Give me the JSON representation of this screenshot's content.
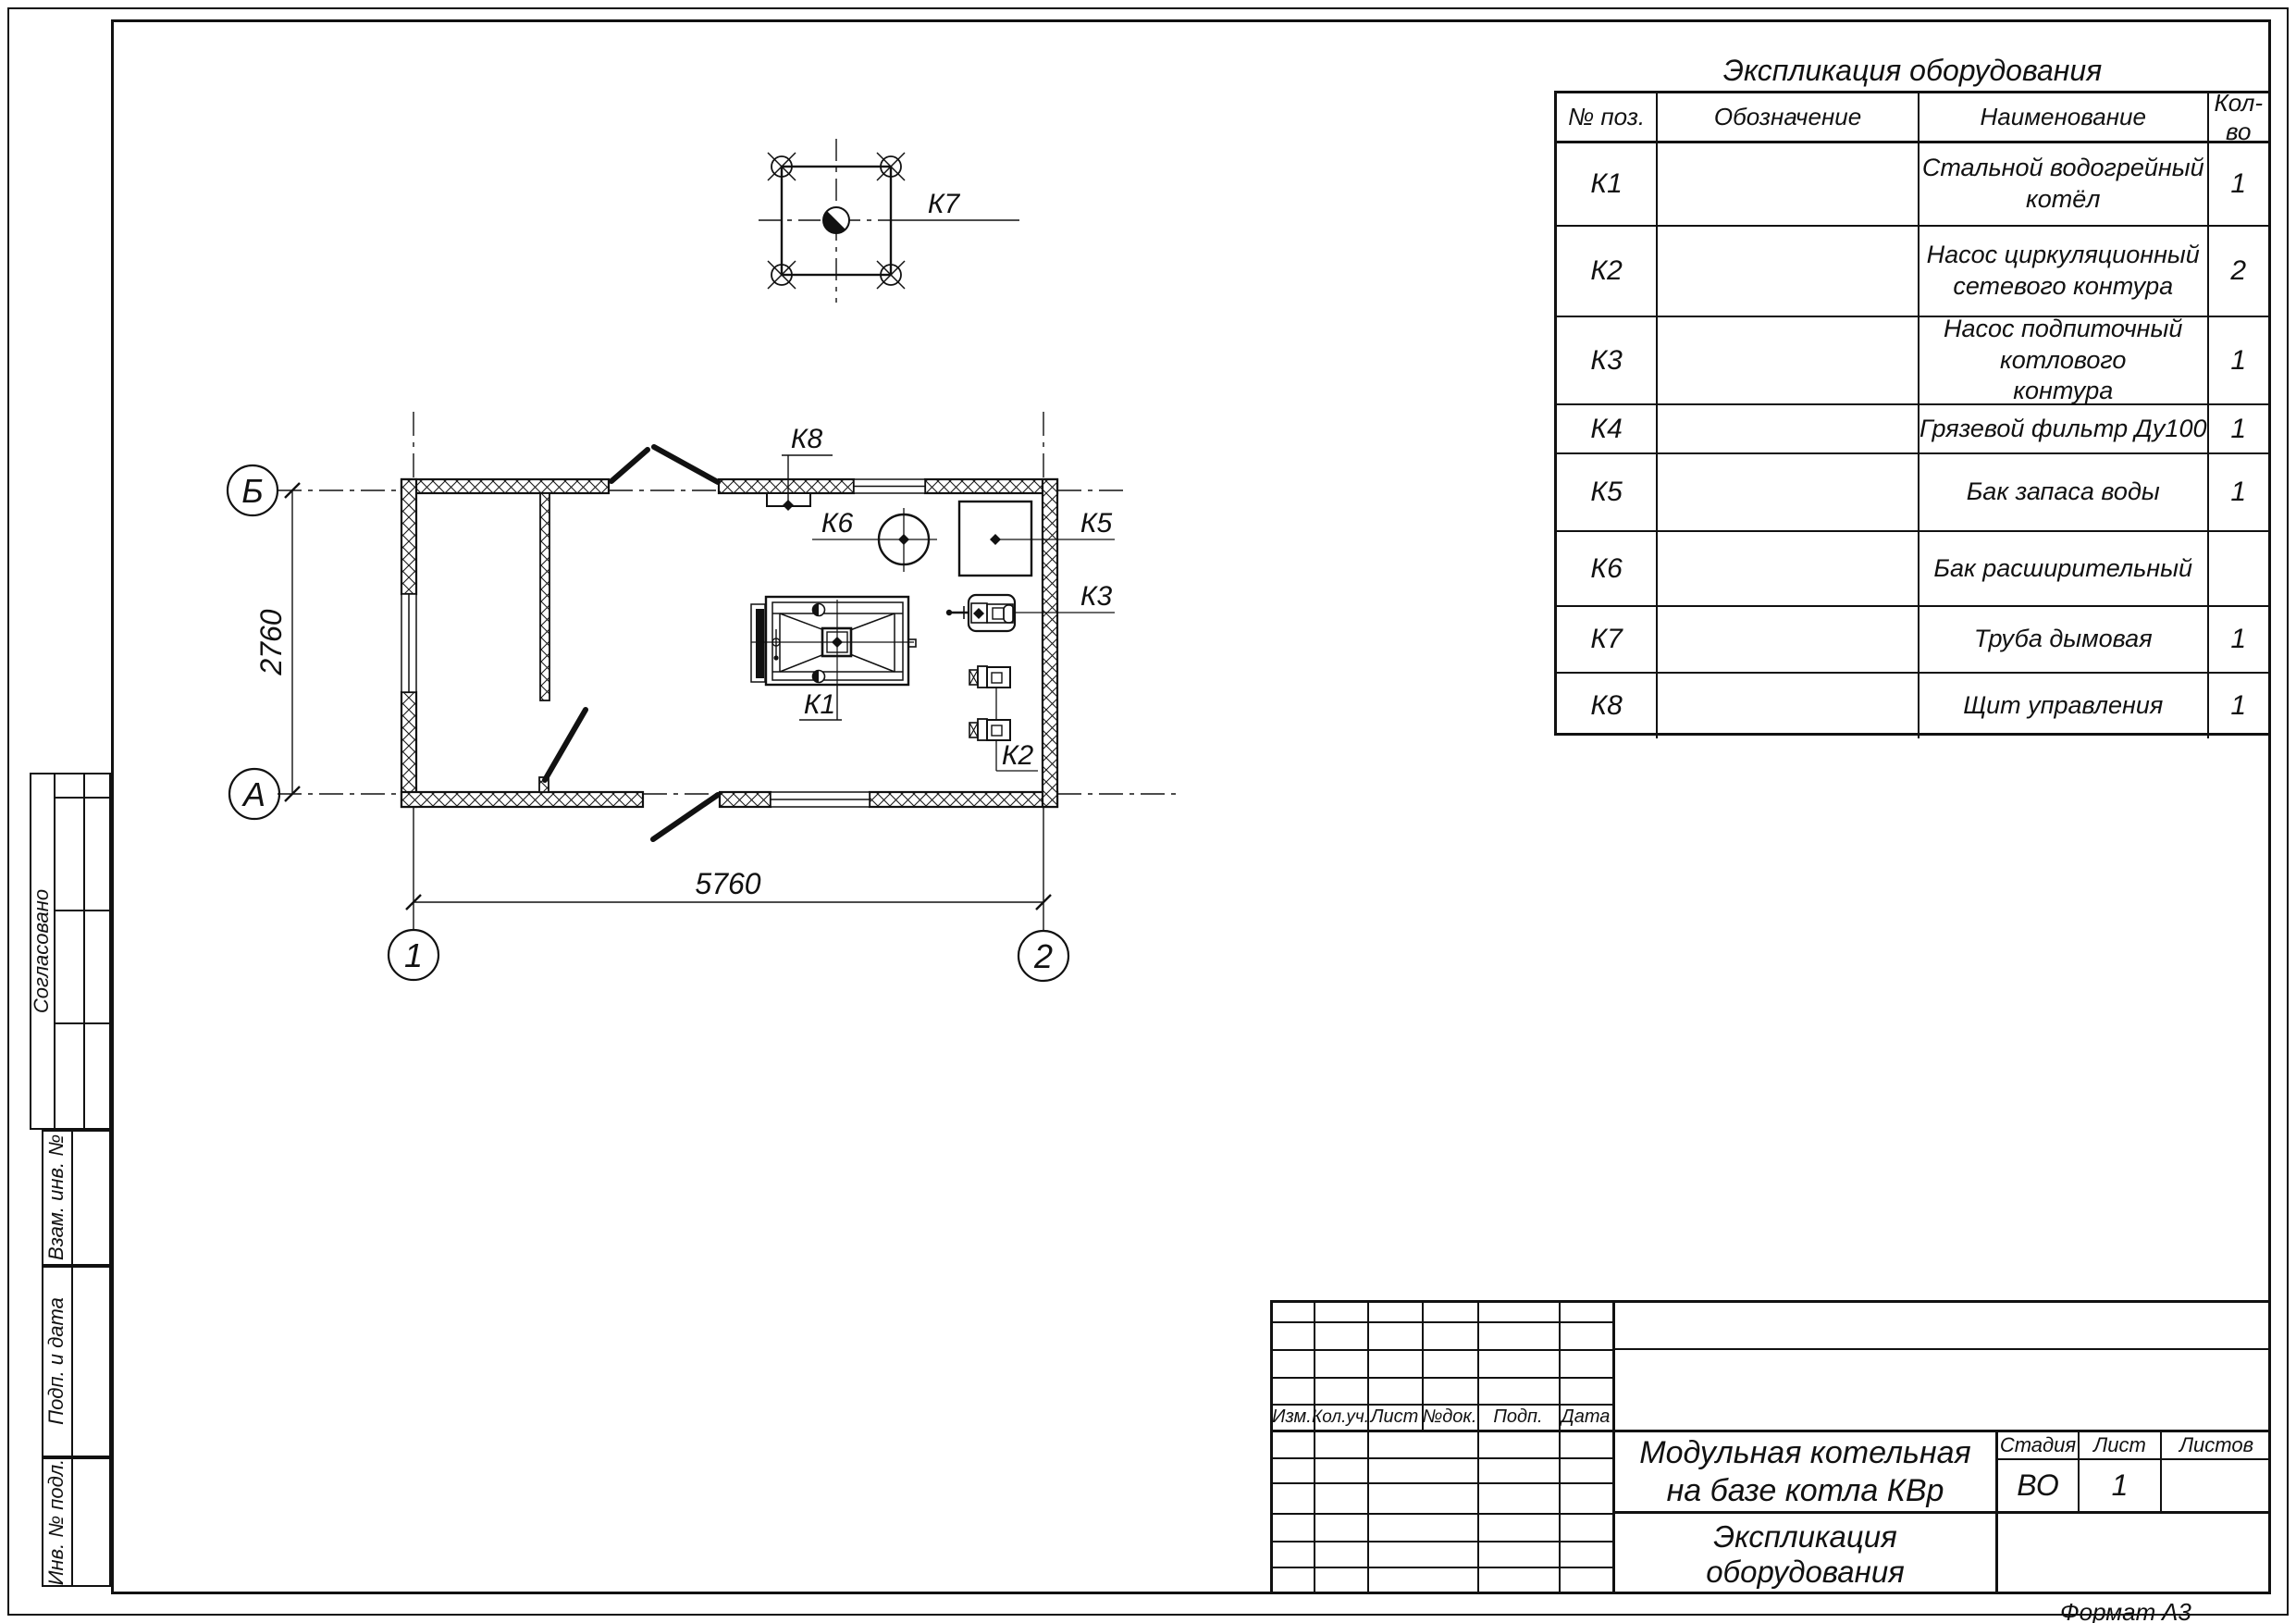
{
  "drawing": {
    "plan_labels": {
      "k1": "К1",
      "k2": "К2",
      "k3": "К3",
      "k5": "К5",
      "k6": "К6",
      "k7": "К7",
      "k8": "К8"
    },
    "axes": {
      "row_top": "Б",
      "row_bottom": "А",
      "col_left": "1",
      "col_right": "2"
    },
    "dimensions": {
      "width_mm": "5760",
      "height_mm": "2760"
    }
  },
  "equipment_table": {
    "title": "Экспликация оборудования",
    "headers": {
      "pos": "№ поз.",
      "designation": "Обозначение",
      "name": "Наименование",
      "qty": "Кол-во"
    },
    "rows": [
      {
        "pos": "К1",
        "designation": "",
        "name": "Стальной водогрейный котёл",
        "qty": "1"
      },
      {
        "pos": "К2",
        "designation": "",
        "name": "Насос циркуляционный\nсетевого контура",
        "qty": "2"
      },
      {
        "pos": "К3",
        "designation": "",
        "name": "Насос подпиточный котлового\nконтура",
        "qty": "1"
      },
      {
        "pos": "К4",
        "designation": "",
        "name": "Грязевой фильтр Ду100",
        "qty": "1"
      },
      {
        "pos": "К5",
        "designation": "",
        "name": "Бак запаса воды",
        "qty": "1"
      },
      {
        "pos": "К6",
        "designation": "",
        "name": "Бак расширительный",
        "qty": ""
      },
      {
        "pos": "К7",
        "designation": "",
        "name": "Труба дымовая",
        "qty": "1"
      },
      {
        "pos": "К8",
        "designation": "",
        "name": "Щит управления",
        "qty": "1"
      }
    ]
  },
  "left_strip": {
    "approved": "Согласовано",
    "repl_inv": "Взам. инв. №",
    "sign_date": "Подп. и дата",
    "inv_orig": "Инв. № подл."
  },
  "title_block": {
    "rev_headers": {
      "izm": "Изм.",
      "koluch": "Кол.уч.",
      "list": "Лист",
      "ndok": "№док.",
      "podp": "Подп.",
      "data": "Дата"
    },
    "project_title": "Модульная котельная\nна базе котла КВр",
    "doc_title": "Экспликация оборудования",
    "stage_label": "Стадия",
    "sheet_label": "Лист",
    "sheets_label": "Листов",
    "stage_value": "ВО",
    "sheet_value": "1",
    "sheets_value": ""
  },
  "footer": {
    "format_label": "Формат",
    "format_value": "А3"
  }
}
